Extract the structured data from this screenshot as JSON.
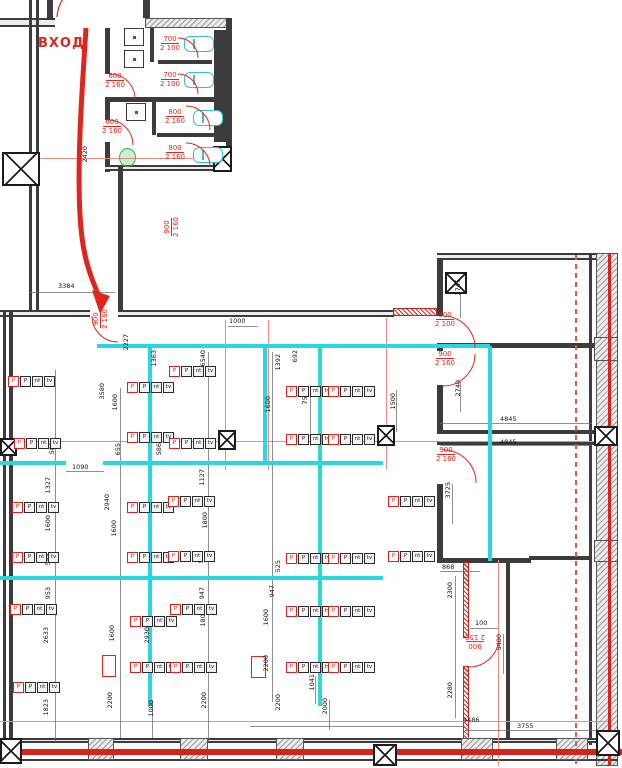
{
  "entrance": {
    "label": "ВХОД"
  },
  "colors": {
    "accent_red": "#e0251c",
    "partition_cyan": "#2bd7de",
    "fixture_cyan": "#38bfc9",
    "wall_gray": "#3c3c3c",
    "urinal_green": "#3fae49"
  },
  "outlet_strip": {
    "cells": [
      "P",
      "P",
      "nt",
      "tv"
    ]
  },
  "door_labels": [
    {
      "w": "600",
      "h": "2 160",
      "x": 98,
      "y": 72,
      "r": 0
    },
    {
      "w": "600",
      "h": "2 160",
      "x": 95,
      "y": 118,
      "r": 0
    },
    {
      "w": "700",
      "h": "2 100",
      "x": 153,
      "y": 35,
      "r": 0
    },
    {
      "w": "700",
      "h": "2 100",
      "x": 153,
      "y": 71,
      "r": 0
    },
    {
      "w": "800",
      "h": "2 160",
      "x": 158,
      "y": 108,
      "r": 0
    },
    {
      "w": "800",
      "h": "2 160",
      "x": 158,
      "y": 144,
      "r": 0
    },
    {
      "w": "900",
      "h": "2 160",
      "x": 92,
      "y": 336,
      "r": 90
    },
    {
      "w": "900",
      "h": "2 160",
      "x": 163,
      "y": 244,
      "r": 90
    },
    {
      "w": "900",
      "h": "2 100",
      "x": 428,
      "y": 311,
      "r": 0
    },
    {
      "w": "900",
      "h": "2 160",
      "x": 428,
      "y": 350,
      "r": 0
    },
    {
      "w": "900",
      "h": "2 160",
      "x": 429,
      "y": 446,
      "r": 0
    },
    {
      "w": "900",
      "h": "2 150",
      "x": 458,
      "y": 633,
      "r": 180
    }
  ],
  "dimensions": [
    {
      "t": "3384",
      "x": 58,
      "y": 283,
      "o": "h"
    },
    {
      "t": "1000",
      "x": 229,
      "y": 318,
      "o": "h"
    },
    {
      "t": "1090",
      "x": 72,
      "y": 464,
      "o": "h"
    },
    {
      "t": "4845",
      "x": 500,
      "y": 416,
      "o": "h"
    },
    {
      "t": "4845",
      "x": 500,
      "y": 439,
      "o": "h"
    },
    {
      "t": "868",
      "x": 442,
      "y": 564,
      "o": "h"
    },
    {
      "t": "100",
      "x": 475,
      "y": 620,
      "o": "h"
    },
    {
      "t": "4486",
      "x": 463,
      "y": 717,
      "o": "h"
    },
    {
      "t": "3755",
      "x": 517,
      "y": 723,
      "o": "h"
    },
    {
      "t": "2420",
      "x": 82,
      "y": 146,
      "o": "v"
    },
    {
      "t": "2227",
      "x": 123,
      "y": 334,
      "o": "v"
    },
    {
      "t": "6540",
      "x": 200,
      "y": 350,
      "o": "v"
    },
    {
      "t": "1363",
      "x": 151,
      "y": 350,
      "o": "v"
    },
    {
      "t": "3580",
      "x": 99,
      "y": 383,
      "o": "v"
    },
    {
      "t": "1600",
      "x": 112,
      "y": 394,
      "o": "v"
    },
    {
      "t": "1392",
      "x": 275,
      "y": 354,
      "o": "v"
    },
    {
      "t": "692",
      "x": 292,
      "y": 350,
      "o": "v"
    },
    {
      "t": "7580",
      "x": 302,
      "y": 388,
      "o": "v"
    },
    {
      "t": "1600",
      "x": 265,
      "y": 396,
      "o": "v"
    },
    {
      "t": "1500",
      "x": 390,
      "y": 393,
      "o": "v"
    },
    {
      "t": "588",
      "x": 49,
      "y": 442,
      "o": "v"
    },
    {
      "t": "655",
      "x": 115,
      "y": 443,
      "o": "v"
    },
    {
      "t": "586",
      "x": 156,
      "y": 443,
      "o": "v"
    },
    {
      "t": "1327",
      "x": 45,
      "y": 477,
      "o": "v"
    },
    {
      "t": "1600",
      "x": 45,
      "y": 515,
      "o": "v"
    },
    {
      "t": "555",
      "x": 45,
      "y": 553,
      "o": "v"
    },
    {
      "t": "2940",
      "x": 104,
      "y": 494,
      "o": "v"
    },
    {
      "t": "1600",
      "x": 111,
      "y": 520,
      "o": "v"
    },
    {
      "t": "1127",
      "x": 199,
      "y": 469,
      "o": "v"
    },
    {
      "t": "1800",
      "x": 202,
      "y": 512,
      "o": "v"
    },
    {
      "t": "555",
      "x": 198,
      "y": 551,
      "o": "v"
    },
    {
      "t": "953",
      "x": 45,
      "y": 587,
      "o": "v"
    },
    {
      "t": "2633",
      "x": 43,
      "y": 627,
      "o": "v"
    },
    {
      "t": "1823",
      "x": 43,
      "y": 699,
      "o": "v"
    },
    {
      "t": "1600",
      "x": 109,
      "y": 625,
      "o": "v"
    },
    {
      "t": "2930",
      "x": 144,
      "y": 627,
      "o": "v"
    },
    {
      "t": "2200",
      "x": 107,
      "y": 692,
      "o": "v"
    },
    {
      "t": "947",
      "x": 199,
      "y": 587,
      "o": "v"
    },
    {
      "t": "1800",
      "x": 200,
      "y": 610,
      "o": "v"
    },
    {
      "t": "2200",
      "x": 201,
      "y": 692,
      "o": "v"
    },
    {
      "t": "947",
      "x": 269,
      "y": 585,
      "o": "v"
    },
    {
      "t": "1600",
      "x": 263,
      "y": 609,
      "o": "v"
    },
    {
      "t": "2200",
      "x": 263,
      "y": 655,
      "o": "v"
    },
    {
      "t": "525",
      "x": 275,
      "y": 560,
      "o": "v"
    },
    {
      "t": "1041",
      "x": 309,
      "y": 674,
      "o": "v"
    },
    {
      "t": "2000",
      "x": 322,
      "y": 698,
      "o": "v"
    },
    {
      "t": "1000",
      "x": 148,
      "y": 700,
      "o": "v"
    },
    {
      "t": "2200",
      "x": 275,
      "y": 694,
      "o": "v"
    },
    {
      "t": "2745",
      "x": 455,
      "y": 279,
      "o": "v"
    },
    {
      "t": "2740",
      "x": 455,
      "y": 380,
      "o": "v"
    },
    {
      "t": "3725",
      "x": 445,
      "y": 482,
      "o": "v"
    },
    {
      "t": "2300",
      "x": 447,
      "y": 582,
      "o": "v"
    },
    {
      "t": "5480",
      "x": 496,
      "y": 634,
      "o": "v"
    },
    {
      "t": "2280",
      "x": 447,
      "y": 682,
      "o": "v"
    }
  ],
  "outlet_strips": [
    {
      "x": 8,
      "y": 376
    },
    {
      "x": 14,
      "y": 438
    },
    {
      "x": 12,
      "y": 502
    },
    {
      "x": 12,
      "y": 552
    },
    {
      "x": 10,
      "y": 604
    },
    {
      "x": 13,
      "y": 682
    },
    {
      "x": 127,
      "y": 382
    },
    {
      "x": 127,
      "y": 432
    },
    {
      "x": 127,
      "y": 502
    },
    {
      "x": 127,
      "y": 552
    },
    {
      "x": 130,
      "y": 616
    },
    {
      "x": 130,
      "y": 662
    },
    {
      "x": 169,
      "y": 366
    },
    {
      "x": 169,
      "y": 438
    },
    {
      "x": 168,
      "y": 496
    },
    {
      "x": 168,
      "y": 551
    },
    {
      "x": 170,
      "y": 604
    },
    {
      "x": 170,
      "y": 662
    },
    {
      "x": 286,
      "y": 386
    },
    {
      "x": 286,
      "y": 434
    },
    {
      "x": 286,
      "y": 553
    },
    {
      "x": 286,
      "y": 606
    },
    {
      "x": 286,
      "y": 662
    },
    {
      "x": 328,
      "y": 386
    },
    {
      "x": 328,
      "y": 434
    },
    {
      "x": 328,
      "y": 553
    },
    {
      "x": 328,
      "y": 606
    },
    {
      "x": 328,
      "y": 662
    },
    {
      "x": 388,
      "y": 496
    },
    {
      "x": 388,
      "y": 551
    }
  ]
}
